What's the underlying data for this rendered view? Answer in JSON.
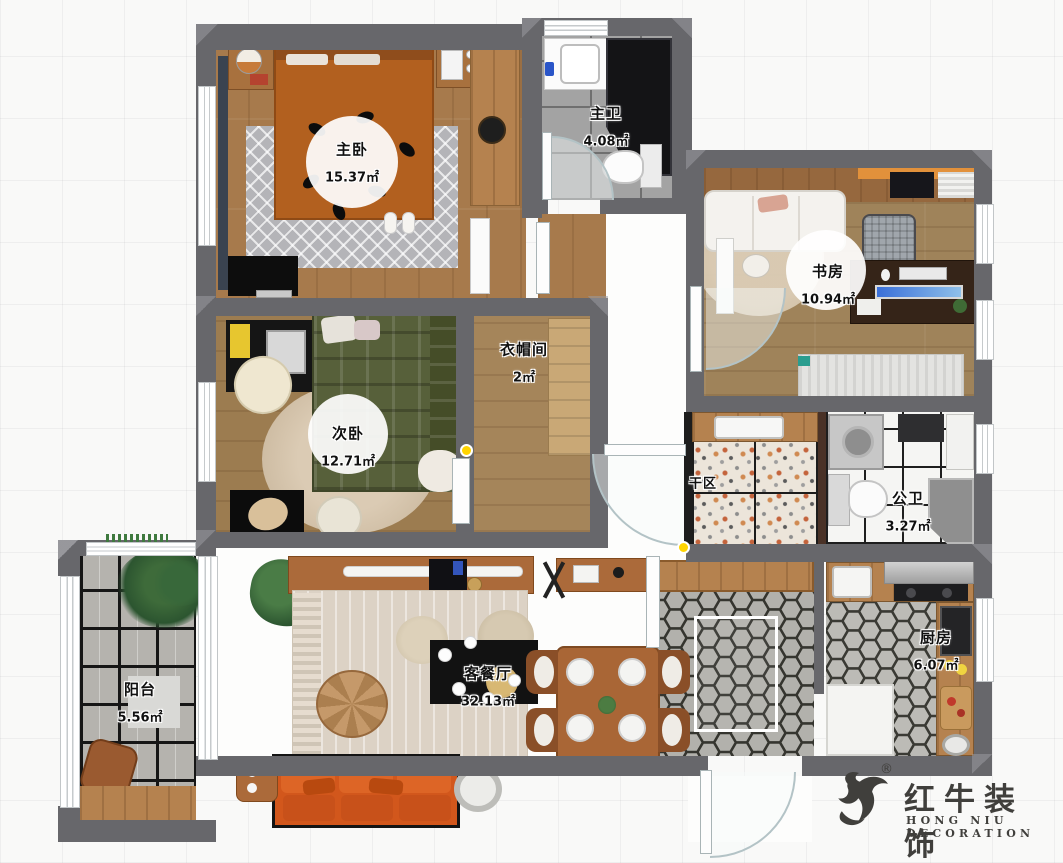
{
  "plan": {
    "rooms": [
      {
        "id": "master-bedroom",
        "name": "主卧",
        "area": "15.37㎡"
      },
      {
        "id": "master-bath",
        "name": "主卫",
        "area": "4.08㎡"
      },
      {
        "id": "study",
        "name": "书房",
        "area": "10.94㎡"
      },
      {
        "id": "cloakroom",
        "name": "衣帽间",
        "area": "2㎡"
      },
      {
        "id": "second-bedroom",
        "name": "次卧",
        "area": "12.71㎡"
      },
      {
        "id": "dry-area",
        "name": "干区",
        "area": ""
      },
      {
        "id": "public-bath",
        "name": "公卫",
        "area": "3.27㎡"
      },
      {
        "id": "kitchen",
        "name": "厨房",
        "area": "6.07㎡"
      },
      {
        "id": "balcony",
        "name": "阳台",
        "area": "5.56㎡"
      },
      {
        "id": "living-dining",
        "name": "客餐厅",
        "area": "32.13㎡"
      }
    ]
  },
  "logo": {
    "brand": "红牛装饰",
    "subtitle": "HONG NIU DECORATION",
    "registered": "®"
  },
  "colors": {
    "wall": "#67676b",
    "accent_orange_sofa": "#d2571c",
    "accent_bed": "#b2601f",
    "marker_yellow": "#ffd400"
  }
}
